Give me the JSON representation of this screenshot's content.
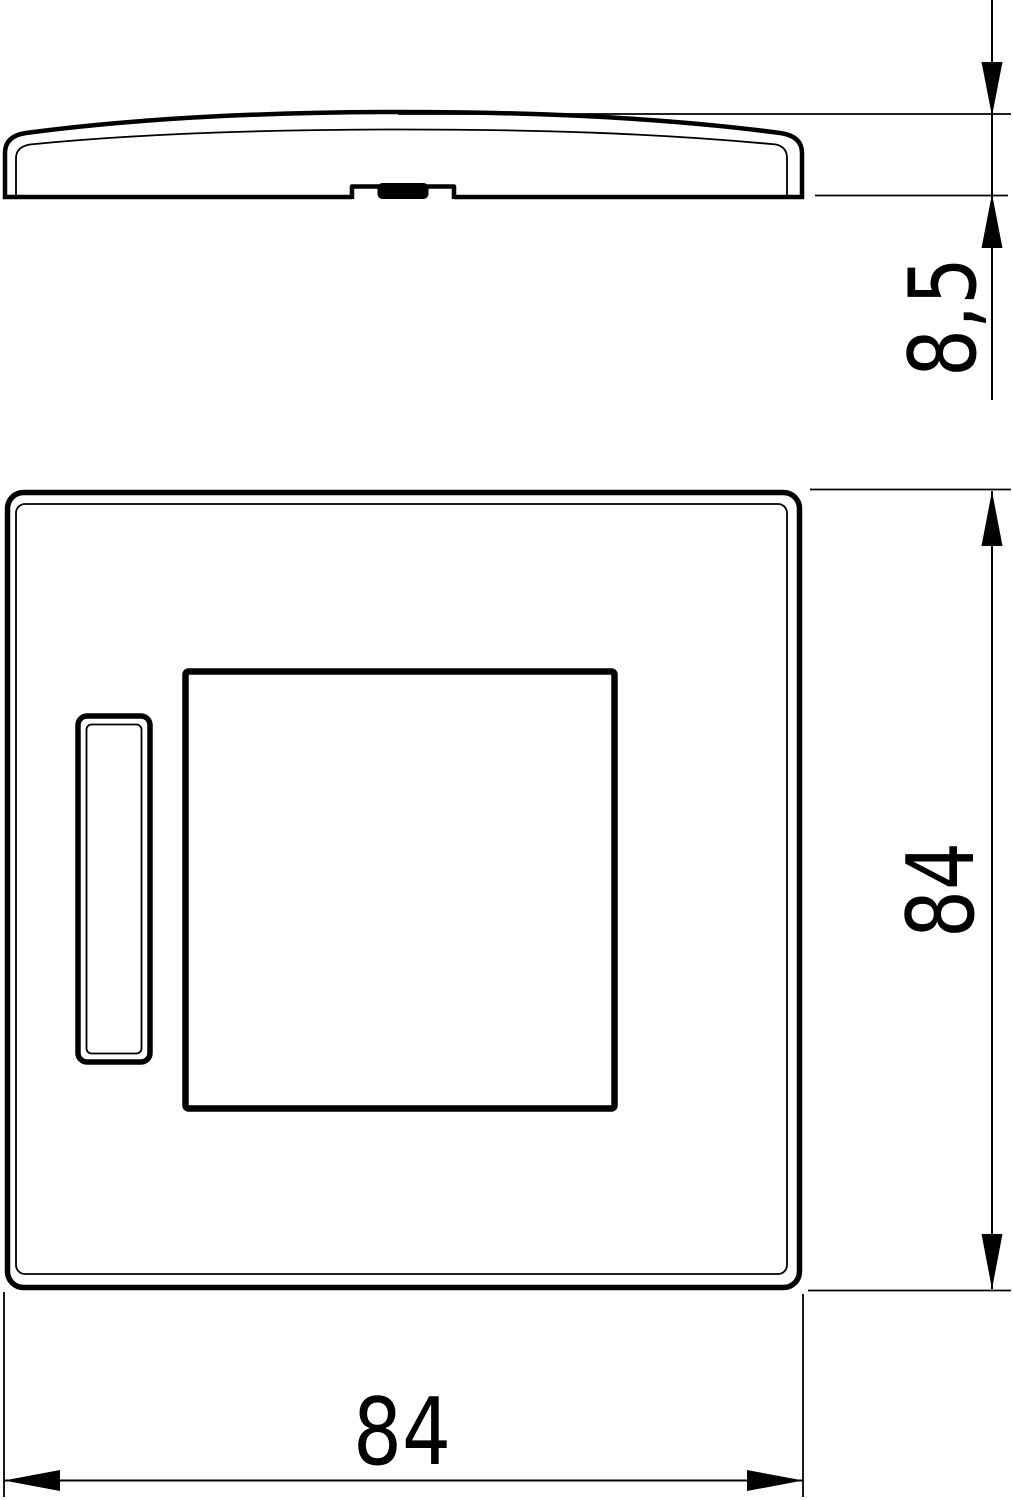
{
  "page": {
    "background_color": "#ffffff",
    "line_color": "#000000"
  },
  "drawing": {
    "kind": "technical dimension drawing, two orthographic views of a square cover plate"
  },
  "dimensions": {
    "thickness": {
      "text": "8,5"
    },
    "height": {
      "text": "84"
    },
    "width": {
      "text": "84"
    }
  }
}
